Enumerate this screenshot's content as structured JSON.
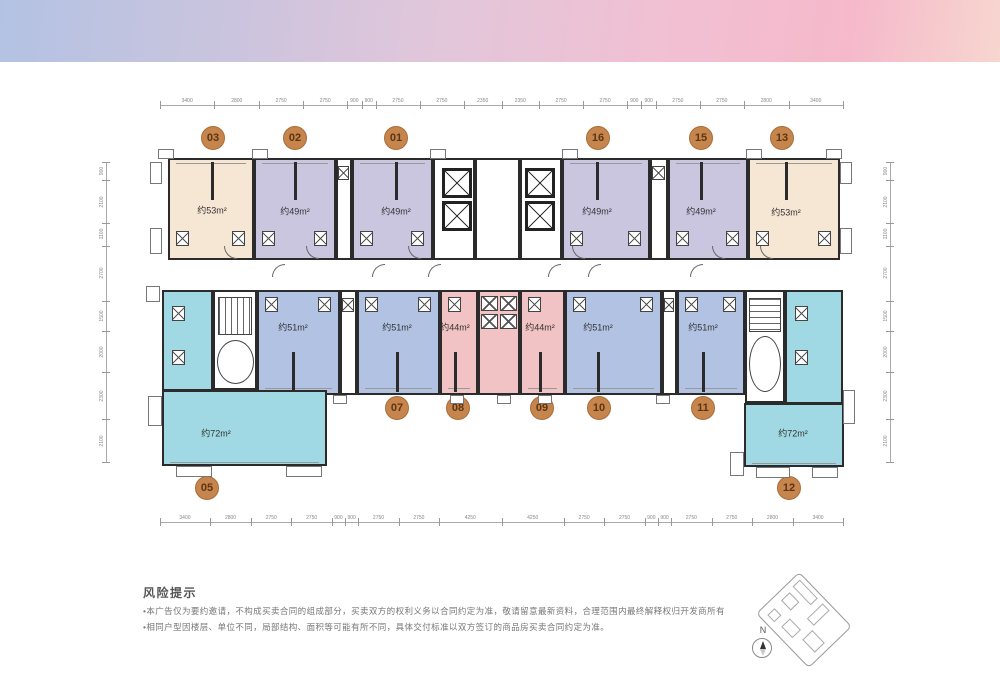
{
  "palette": {
    "wall": "#2b2b2b",
    "cream": "#f6e7d5",
    "purple": "#cac6df",
    "blue": "#b2c2e3",
    "pink": "#f1c3c5",
    "cyan": "#a0d9e3",
    "badge_bg": "#c5854d",
    "badge_text": "#5e3513"
  },
  "units": [
    {
      "id": "03",
      "area": "约53m²",
      "color": "cream"
    },
    {
      "id": "02",
      "area": "约49m²",
      "color": "purple"
    },
    {
      "id": "01",
      "area": "约49m²",
      "color": "purple"
    },
    {
      "id": "16",
      "area": "约49m²",
      "color": "purple"
    },
    {
      "id": "15",
      "area": "约49m²",
      "color": "purple"
    },
    {
      "id": "13",
      "area": "约53m²",
      "color": "cream"
    },
    {
      "id": "06",
      "area": "约51m²",
      "color": "blue"
    },
    {
      "id": "07",
      "area": "约51m²",
      "color": "blue"
    },
    {
      "id": "08",
      "area": "约44m²",
      "color": "pink"
    },
    {
      "id": "09",
      "area": "约44m²",
      "color": "pink"
    },
    {
      "id": "10",
      "area": "约51m²",
      "color": "blue"
    },
    {
      "id": "11",
      "area": "约51m²",
      "color": "blue"
    },
    {
      "id": "05",
      "area": "约72m²",
      "color": "cyan"
    },
    {
      "id": "12",
      "area": "约72m²",
      "color": "cyan"
    }
  ],
  "dimensions": {
    "top": [
      "3400",
      "2800",
      "2750",
      "2750",
      "900",
      "900",
      "2750",
      "2750",
      "2350",
      "2350",
      "2750",
      "2750",
      "900",
      "900",
      "2750",
      "2750",
      "2800",
      "3400"
    ],
    "bottom": [
      "3400",
      "2800",
      "2750",
      "2750",
      "900",
      "900",
      "2750",
      "2750",
      "4250",
      "4250",
      "2750",
      "2750",
      "900",
      "900",
      "2750",
      "2750",
      "2800",
      "3400"
    ],
    "left": [
      "900",
      "2100",
      "1100",
      "2700",
      "1500",
      "2000",
      "2300",
      "2100"
    ],
    "right": [
      "900",
      "2100",
      "1100",
      "2700",
      "1500",
      "2000",
      "2300",
      "2100"
    ]
  },
  "risk_notice": {
    "title": "风险提示",
    "bullets": [
      "•本广告仅为要约邀请，不构成买卖合同的组成部分，买卖双方的权利义务以合同约定为准，敬请留意最新资料，合理范围内最终解释权归开发商所有",
      "•相同户型因楼层、单位不同，局部结构、面积等可能有所不同，具体交付标准以双方签订的商品房买卖合同约定为准。"
    ]
  },
  "compass": {
    "label": "N"
  }
}
